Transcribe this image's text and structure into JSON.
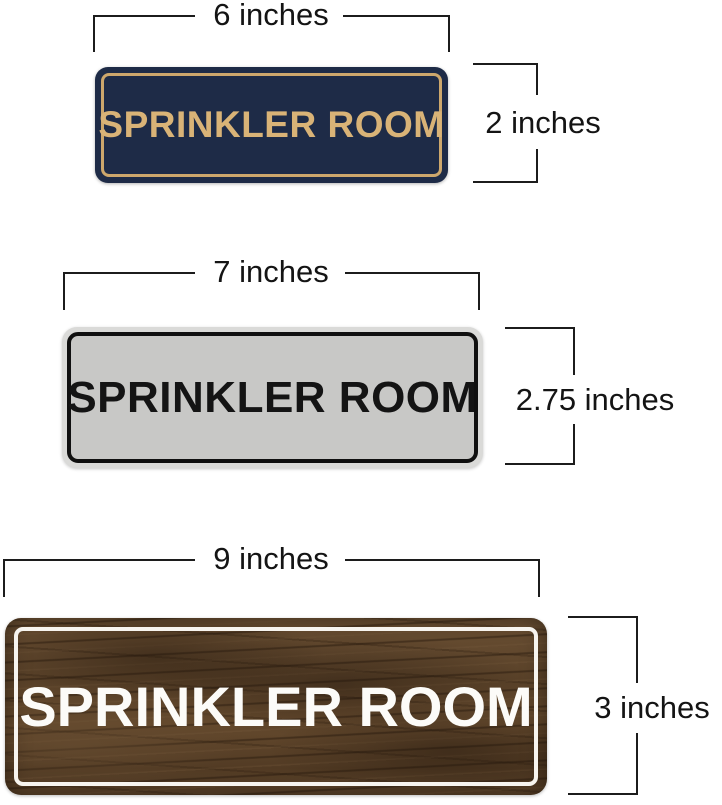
{
  "page": {
    "background": "#ffffff",
    "dimension_line_color": "#1c1c1c",
    "dimension_text_color": "#141414"
  },
  "signs": [
    {
      "id": "navy-gold",
      "label": "SPRINKLER ROOM",
      "width_label": "6 inches",
      "height_label": "2 inches",
      "colors": {
        "plate": "#1e2b47",
        "pinstripe": "#cda76c",
        "text": "#d9b377"
      }
    },
    {
      "id": "silver-black",
      "label": "SPRINKLER ROOM",
      "width_label": "7 inches",
      "height_label": "2.75 inches",
      "colors": {
        "rim": "#dadad8",
        "plate": "#c8c8c6",
        "pinstripe": "#101010",
        "text": "#141414"
      }
    },
    {
      "id": "walnut-wood",
      "label": "SPRINKLER ROOM",
      "width_label": "9 inches",
      "height_label": "3 inches",
      "colors": {
        "plate": "#59422b",
        "grain_dark": "#3a2715",
        "grain_light": "#6e5236",
        "pinstripe": "#f7f4ef",
        "text": "#fcfbf8"
      }
    }
  ]
}
